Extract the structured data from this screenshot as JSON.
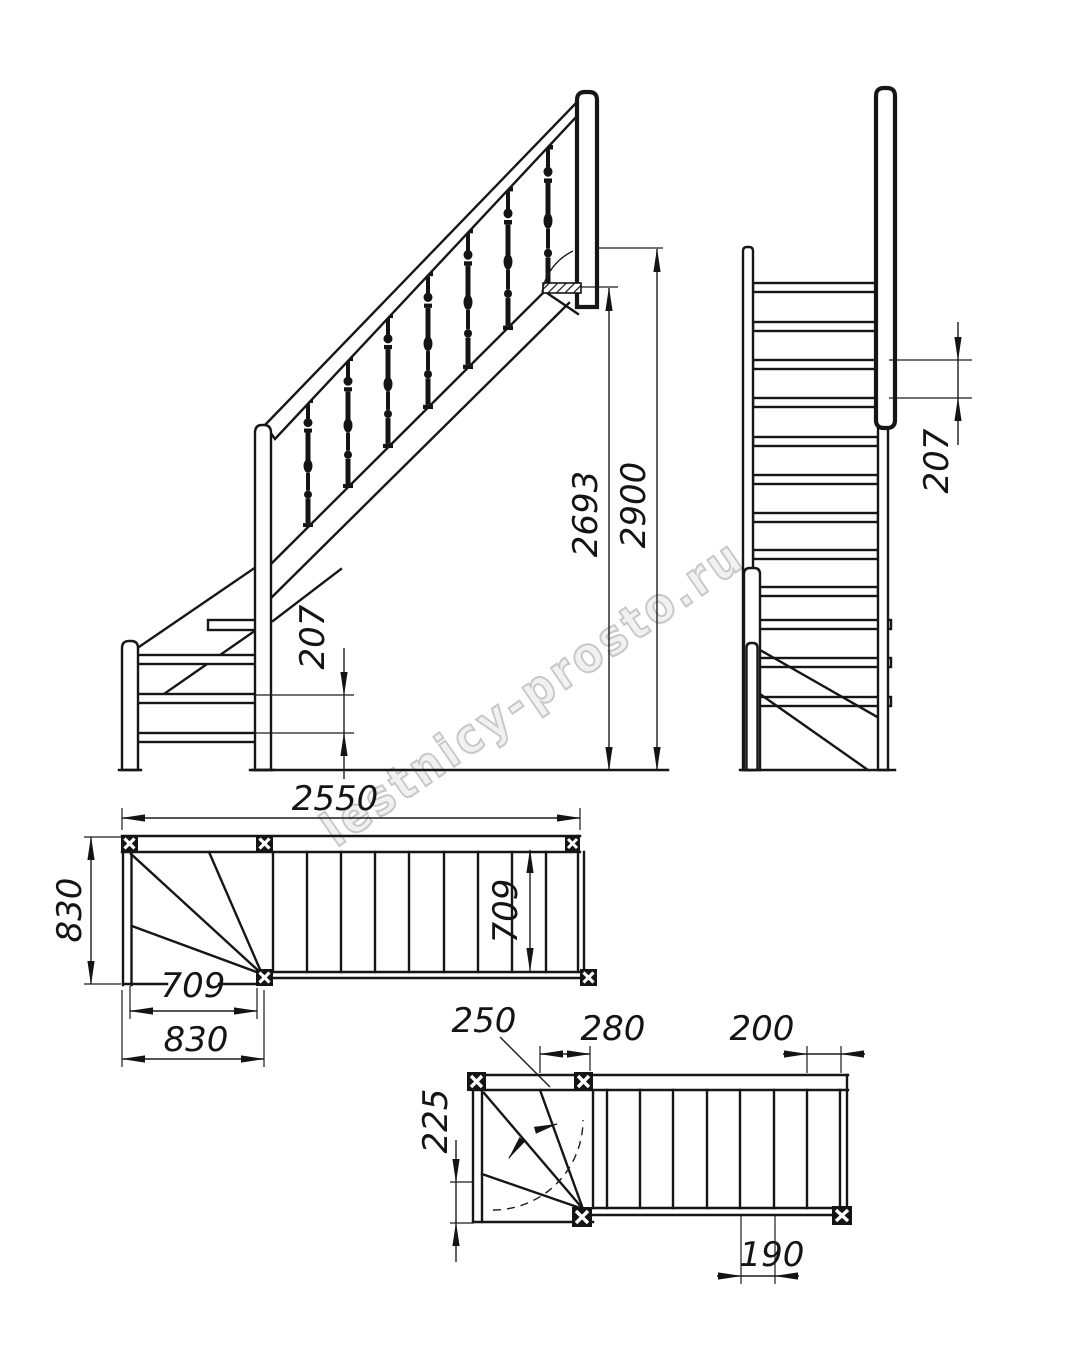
{
  "watermark": "lestnicy-prosto.ru",
  "views": {
    "side_elevation": {
      "riser": "207",
      "floor_to_landing": "2693",
      "floor_to_floor": "2900"
    },
    "front_elevation": {
      "riser": "207"
    },
    "plan_upper": {
      "total_run": "2550",
      "stair_width": "830",
      "flight_inner_width": "709",
      "winder_run": "709",
      "winder_width": "830"
    },
    "plan_lower": {
      "winder_tread_walkline": "250",
      "winder_to_post": "280",
      "top_tread": "200",
      "winder_edge": "225",
      "tread_depth": "190"
    }
  }
}
